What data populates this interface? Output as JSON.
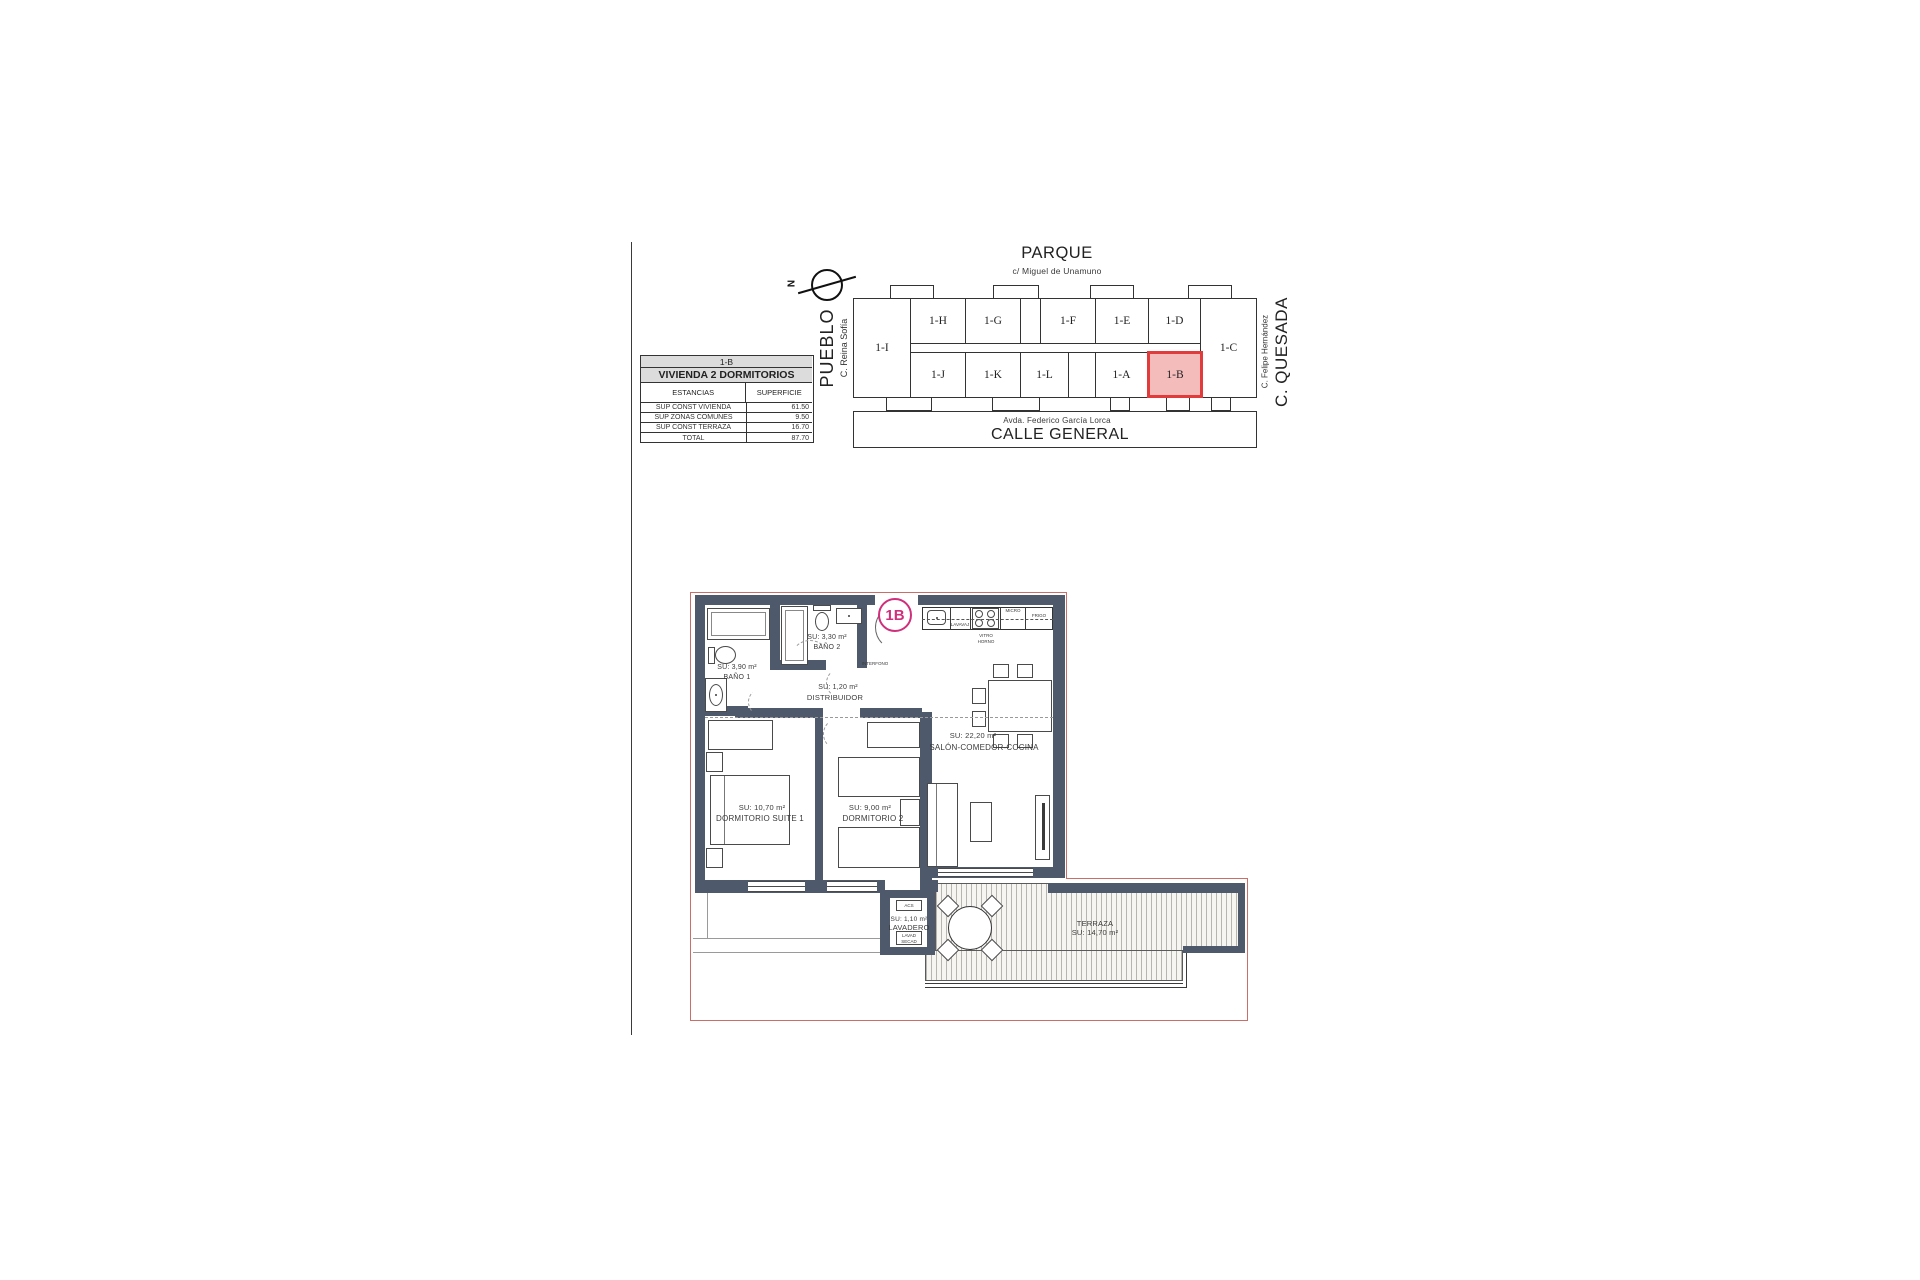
{
  "site_plan": {
    "park_label": "PARQUE",
    "park_street": "c/ Miguel de Unamuno",
    "left_street_primary": "PUEBLO",
    "left_street_secondary": "C. Reina Sofía",
    "right_street_primary": "C. QUESADA",
    "right_street_secondary": "C. Felipe Hernández",
    "bottom_street_primary": "CALLE GENERAL",
    "bottom_street_secondary": "Avda. Federico García Lorca",
    "north_label": "N",
    "units": {
      "i": "1-I",
      "h": "1-H",
      "g": "1-G",
      "f": "1-F",
      "e": "1-E",
      "d": "1-D",
      "c": "1-C",
      "j": "1-J",
      "k": "1-K",
      "l": "1-L",
      "a": "1-A",
      "b": "1-B"
    },
    "highlighted_unit": "1-B",
    "colors": {
      "highlight_border": "#e13b3b",
      "highlight_fill": "#f5bcbc"
    }
  },
  "summary_table": {
    "unit": "1-B",
    "type": "VIVIENDA 2 DORMITORIOS",
    "col_room": "ESTANCIAS",
    "col_area": "SUPERFICIE",
    "rows": [
      {
        "label": "SUP CONST VIVIENDA",
        "value": "61.50"
      },
      {
        "label": "SUP ZONAS COMUNES",
        "value": "9.50"
      },
      {
        "label": "SUP CONST TERRAZA",
        "value": "16.70"
      },
      {
        "label": "TOTAL",
        "value": "87.70"
      }
    ]
  },
  "floor_plan": {
    "unit_badge": "1B",
    "badge_color": "#cf2f7b",
    "wall_color": "#4e5a6c",
    "boundary_color": "#c96f68",
    "rooms": {
      "bano1": {
        "area": "SU: 3,90 m²",
        "name": "BAÑO 1"
      },
      "bano2": {
        "area": "SU: 3,30 m²",
        "name": "BAÑO 2"
      },
      "distribuidor": {
        "area": "SU: 1,20 m²",
        "name": "DISTRIBUIDOR"
      },
      "salon": {
        "area": "SU: 22,20 m²",
        "name": "SALÓN-COMEDOR-COCINA"
      },
      "dormitorio1": {
        "area": "SU: 10,70 m²",
        "name": "DORMITORIO SUITE 1"
      },
      "dormitorio2": {
        "area": "SU: 9,00 m²",
        "name": "DORMITORIO  2"
      },
      "lavadero": {
        "area": "SU: 1,10 m²",
        "name": "LAVADERO",
        "acs": "ACS",
        "washer": "LAVAD",
        "dryer": "SECAD"
      },
      "terraza": {
        "name": "TERRAZA",
        "area": "SU: 14,70 m²"
      }
    },
    "kitchen": {
      "dishwasher": "LAVAVAJ",
      "hob_line1": "VITRO",
      "hob_line2": "HORNO",
      "micro": "MICRO",
      "fridge": "FRIGO"
    },
    "intercom": "INTERFONO"
  }
}
